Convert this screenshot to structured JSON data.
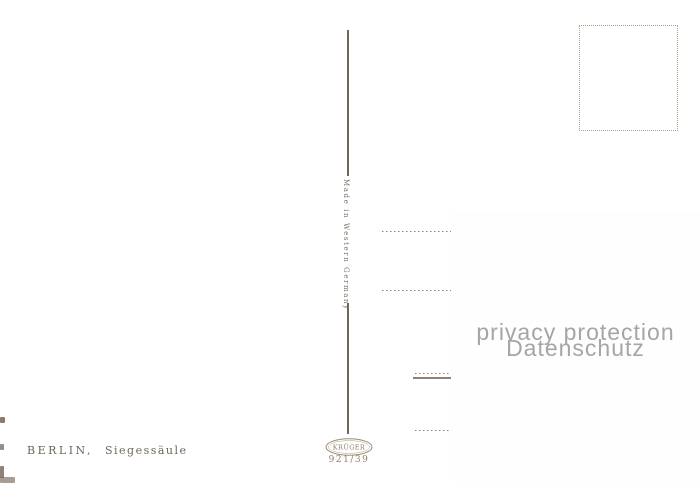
{
  "postcard": {
    "caption": {
      "city": "BERLIN,",
      "subject": "Siegessäule"
    },
    "spine_text": "Made in Western Germany",
    "publisher": "KRÜGER",
    "card_number": "921/39"
  },
  "privacy_overlay": {
    "line1": "privacy protection",
    "line2": "Datenschutz"
  },
  "colors": {
    "paper": "#f5e2c0",
    "ink": "#6e6659",
    "divider_line": "#6f675b",
    "address_line": "#8f8270",
    "overlay_background": "#fefefe",
    "overlay_text": "#a5a5a5"
  }
}
